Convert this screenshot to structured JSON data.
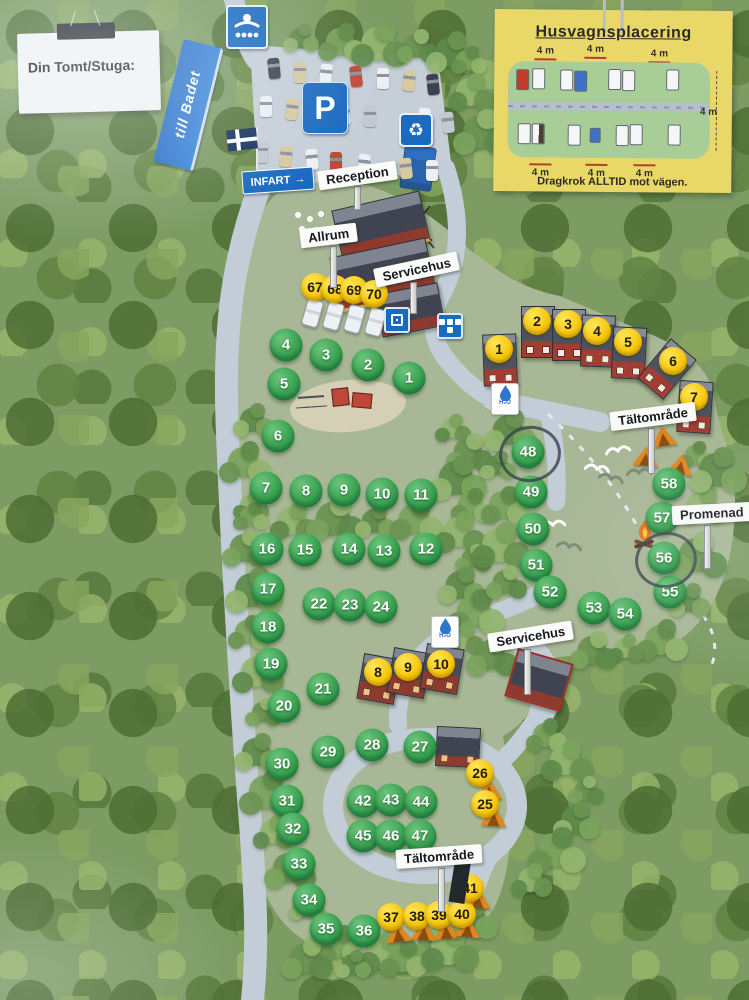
{
  "note": {
    "label": "Din Tomt/Stuga:"
  },
  "legend": {
    "title": "Husvagnsplacering",
    "footer": "Dragkrok ALLTID mot vägen.",
    "spacing_top": [
      "4 m",
      "4 m",
      "4 m"
    ],
    "spacing_bottom": [
      "4 m",
      "4 m",
      "4 m"
    ],
    "spacing_right": "4 m"
  },
  "signs": {
    "bath_direction": "till Badet",
    "entrance": "INFART",
    "entrance_arrow": "→",
    "parking": "P",
    "recycle_icon": "♻",
    "reception": "Reception",
    "common_room": "Allrum",
    "service_house_top": "Servicehus",
    "service_house_mid": "Servicehus",
    "tent_area_right": "Tältområde",
    "tent_area_bottom": "Tältområde",
    "walk": "Promenad"
  },
  "water_label": "H₂O",
  "markers": {
    "green_sites": [
      {
        "n": 1,
        "x": 409,
        "y": 378
      },
      {
        "n": 2,
        "x": 368,
        "y": 365
      },
      {
        "n": 3,
        "x": 326,
        "y": 355
      },
      {
        "n": 4,
        "x": 286,
        "y": 345
      },
      {
        "n": 5,
        "x": 284,
        "y": 384
      },
      {
        "n": 6,
        "x": 278,
        "y": 436
      },
      {
        "n": 7,
        "x": 266,
        "y": 488
      },
      {
        "n": 8,
        "x": 306,
        "y": 491
      },
      {
        "n": 9,
        "x": 344,
        "y": 490
      },
      {
        "n": 10,
        "x": 382,
        "y": 494
      },
      {
        "n": 11,
        "x": 421,
        "y": 495
      },
      {
        "n": 12,
        "x": 426,
        "y": 549
      },
      {
        "n": 13,
        "x": 384,
        "y": 551
      },
      {
        "n": 14,
        "x": 349,
        "y": 549
      },
      {
        "n": 15,
        "x": 305,
        "y": 550
      },
      {
        "n": 16,
        "x": 267,
        "y": 549
      },
      {
        "n": 17,
        "x": 268,
        "y": 589
      },
      {
        "n": 18,
        "x": 268,
        "y": 627
      },
      {
        "n": 19,
        "x": 271,
        "y": 664
      },
      {
        "n": 20,
        "x": 284,
        "y": 706
      },
      {
        "n": 21,
        "x": 323,
        "y": 689
      },
      {
        "n": 22,
        "x": 319,
        "y": 604
      },
      {
        "n": 23,
        "x": 350,
        "y": 605
      },
      {
        "n": 24,
        "x": 381,
        "y": 607
      },
      {
        "n": 27,
        "x": 420,
        "y": 747
      },
      {
        "n": 28,
        "x": 372,
        "y": 745
      },
      {
        "n": 29,
        "x": 328,
        "y": 752
      },
      {
        "n": 30,
        "x": 282,
        "y": 764
      },
      {
        "n": 31,
        "x": 287,
        "y": 801
      },
      {
        "n": 32,
        "x": 293,
        "y": 829
      },
      {
        "n": 33,
        "x": 299,
        "y": 864
      },
      {
        "n": 34,
        "x": 309,
        "y": 900
      },
      {
        "n": 35,
        "x": 326,
        "y": 929
      },
      {
        "n": 36,
        "x": 364,
        "y": 931
      },
      {
        "n": 42,
        "x": 363,
        "y": 801
      },
      {
        "n": 43,
        "x": 391,
        "y": 800
      },
      {
        "n": 44,
        "x": 421,
        "y": 802
      },
      {
        "n": 45,
        "x": 363,
        "y": 836
      },
      {
        "n": 46,
        "x": 391,
        "y": 836
      },
      {
        "n": 47,
        "x": 420,
        "y": 836
      },
      {
        "n": 48,
        "x": 528,
        "y": 452
      },
      {
        "n": 49,
        "x": 531,
        "y": 492
      },
      {
        "n": 50,
        "x": 533,
        "y": 529
      },
      {
        "n": 51,
        "x": 536,
        "y": 565
      },
      {
        "n": 52,
        "x": 550,
        "y": 592
      },
      {
        "n": 53,
        "x": 594,
        "y": 608
      },
      {
        "n": 54,
        "x": 625,
        "y": 614
      },
      {
        "n": 55,
        "x": 670,
        "y": 592
      },
      {
        "n": 56,
        "x": 664,
        "y": 558
      },
      {
        "n": 57,
        "x": 662,
        "y": 518
      },
      {
        "n": 58,
        "x": 669,
        "y": 484
      }
    ],
    "yellow_sites": [
      {
        "n": 67,
        "x": 315,
        "y": 287
      },
      {
        "n": 68,
        "x": 335,
        "y": 289
      },
      {
        "n": 69,
        "x": 354,
        "y": 290
      },
      {
        "n": 70,
        "x": 374,
        "y": 294
      },
      {
        "n": 1,
        "x": 499,
        "y": 349
      },
      {
        "n": 2,
        "x": 537,
        "y": 321
      },
      {
        "n": 3,
        "x": 568,
        "y": 324
      },
      {
        "n": 4,
        "x": 597,
        "y": 331
      },
      {
        "n": 5,
        "x": 628,
        "y": 342
      },
      {
        "n": 6,
        "x": 673,
        "y": 361
      },
      {
        "n": 7,
        "x": 694,
        "y": 397
      },
      {
        "n": 8,
        "x": 378,
        "y": 672
      },
      {
        "n": 9,
        "x": 408,
        "y": 667
      },
      {
        "n": 10,
        "x": 441,
        "y": 664
      },
      {
        "n": 25,
        "x": 485,
        "y": 804
      },
      {
        "n": 26,
        "x": 480,
        "y": 773
      },
      {
        "n": 37,
        "x": 391,
        "y": 917
      },
      {
        "n": 38,
        "x": 417,
        "y": 916
      },
      {
        "n": 39,
        "x": 439,
        "y": 915
      },
      {
        "n": 40,
        "x": 462,
        "y": 914
      },
      {
        "n": 41,
        "x": 470,
        "y": 888
      }
    ]
  },
  "annotations": {
    "circled_sites": [
      48,
      56
    ]
  }
}
